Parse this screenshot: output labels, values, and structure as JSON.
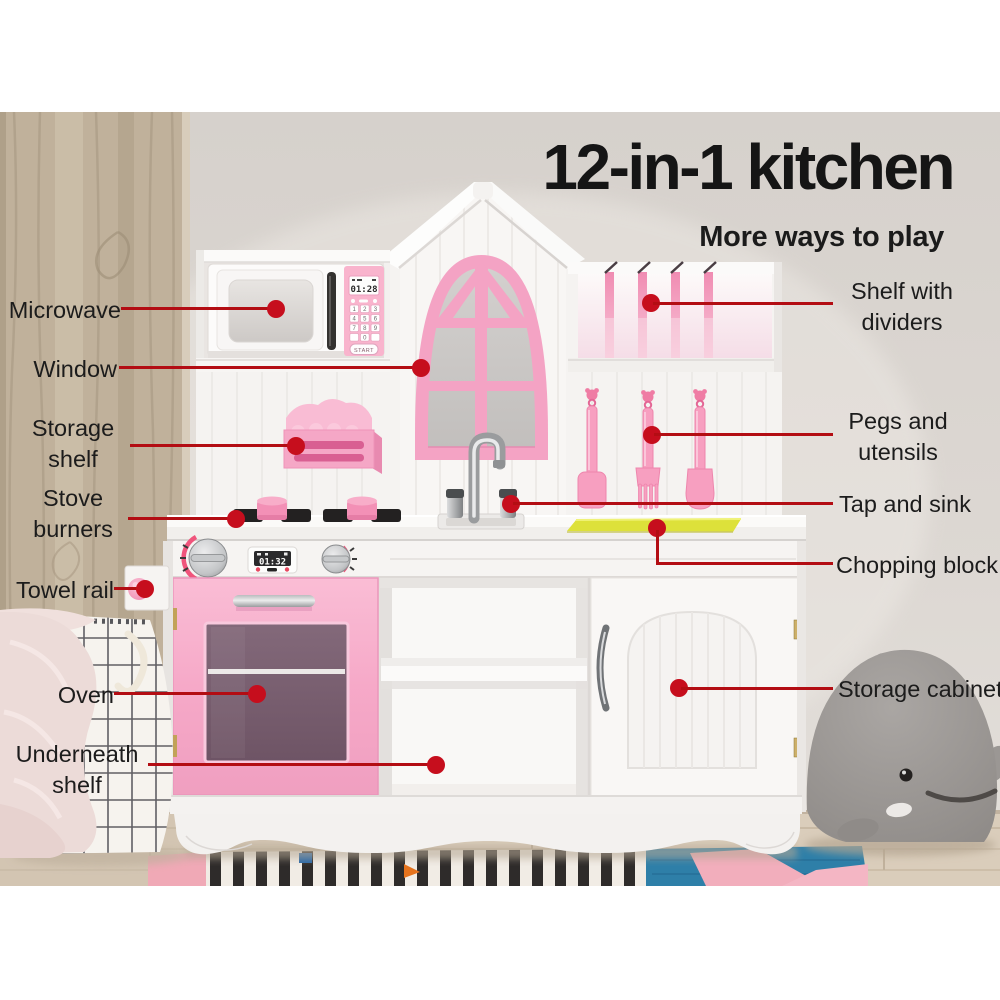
{
  "header": {
    "title": "12-in-1 kitchen",
    "subtitle": "More ways to play"
  },
  "callouts": {
    "left": [
      {
        "label": "Microwave"
      },
      {
        "label": "Window"
      },
      {
        "label": "Storage shelf"
      },
      {
        "label": "Stove burners"
      },
      {
        "label": "Towel rail"
      },
      {
        "label": "Oven"
      },
      {
        "label": "Underneath shelf"
      }
    ],
    "right": [
      {
        "label": "Shelf with dividers"
      },
      {
        "label": "Pegs and utensils"
      },
      {
        "label": "Tap and sink"
      },
      {
        "label": "Chopping block"
      },
      {
        "label": "Storage cabinet"
      }
    ]
  },
  "kitchen": {
    "microwave": {
      "display": "01:28",
      "start_label": "START",
      "keys": [
        "1",
        "2",
        "3",
        "4",
        "5",
        "6",
        "7",
        "8",
        "9",
        "0"
      ]
    },
    "stove": {
      "display": "01:32"
    }
  },
  "colors": {
    "callout_line_red": "#b30d13",
    "callout_dot_red": "#c60e1d",
    "accent_pink": "#f6a8c9",
    "chopping_yellow": "#dde13a",
    "title_black": "#151515"
  }
}
